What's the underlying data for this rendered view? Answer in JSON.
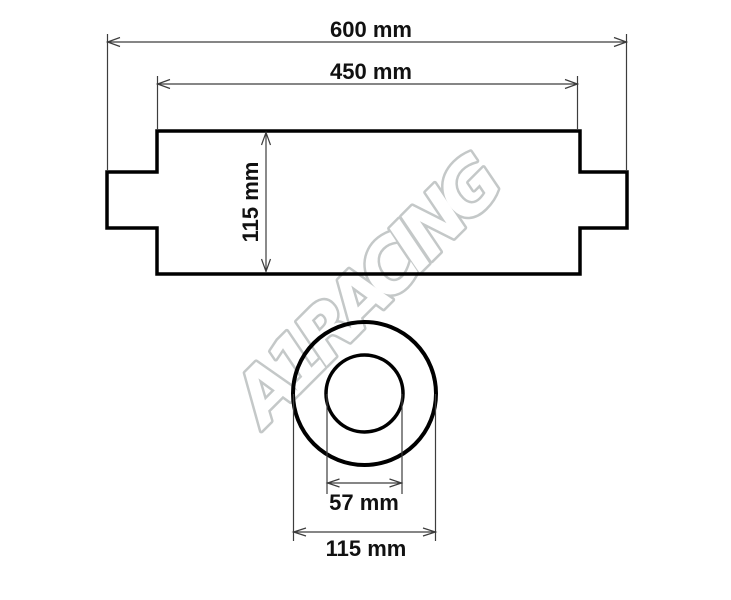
{
  "title": "Muffler / silencer dimension drawing",
  "watermark": {
    "text": "A1RACING"
  },
  "colors": {
    "background": "#ffffff",
    "outline": "#000000",
    "dimension_line": "#3d3d3d",
    "label_text": "#111111",
    "watermark_stroke": "#c4c8c8",
    "watermark_shadow": "#dcdfdf",
    "watermark_fill": "#ffffff"
  },
  "side_view": {
    "overall_length": {
      "value": 600,
      "unit": "mm",
      "label": "600 mm"
    },
    "body_length": {
      "value": 450,
      "unit": "mm",
      "label": "450 mm"
    },
    "body_height": {
      "value": 115,
      "unit": "mm",
      "label": "115 mm"
    }
  },
  "end_view": {
    "inner_diameter": {
      "value": 57,
      "unit": "mm",
      "label": "57 mm"
    },
    "outer_diameter": {
      "value": 115,
      "unit": "mm",
      "label": "115 mm"
    }
  }
}
